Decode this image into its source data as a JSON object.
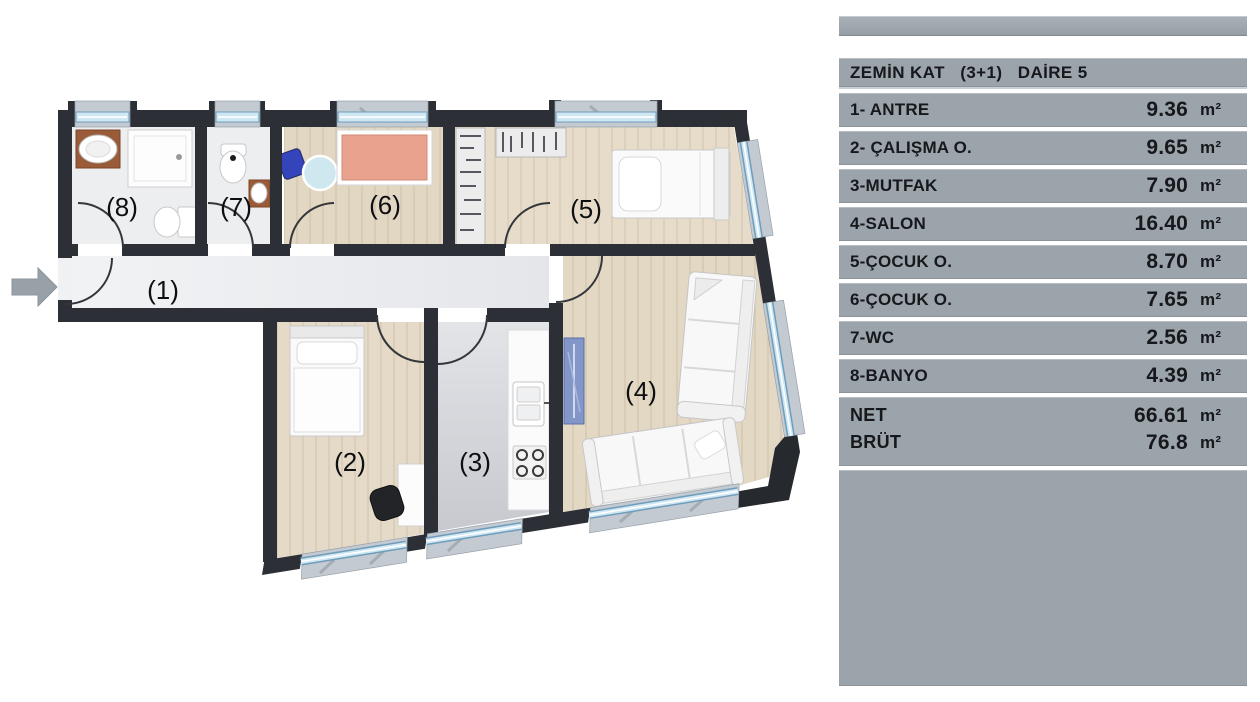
{
  "panel": {
    "title": "ZEMİN KAT   (3+1)   DAİRE 5",
    "rows": [
      {
        "label": "1- ANTRE",
        "value": "9.36",
        "unit": "m²"
      },
      {
        "label": "2- ÇALIŞMA O.",
        "value": "9.65",
        "unit": "m²"
      },
      {
        "label": "3-MUTFAK",
        "value": "7.90",
        "unit": "m²"
      },
      {
        "label": "4-SALON",
        "value": "16.40",
        "unit": "m²"
      },
      {
        "label": "5-ÇOCUK O.",
        "value": "8.70",
        "unit": "m²"
      },
      {
        "label": "6-ÇOCUK O.",
        "value": "7.65",
        "unit": "m²"
      },
      {
        "label": "7-WC",
        "value": "2.56",
        "unit": "m²"
      },
      {
        "label": "8-BANYO",
        "value": "4.39",
        "unit": "m²"
      }
    ],
    "totals": [
      {
        "label": "NET",
        "value": "66.61",
        "unit": "m²"
      },
      {
        "label": "BRÜT",
        "value": "76.8",
        "unit": "m²"
      }
    ]
  },
  "floor_plan": {
    "room_labels": [
      "(1)",
      "(2)",
      "(3)",
      "(4)",
      "(5)",
      "(6)",
      "(7)",
      "(8)"
    ]
  },
  "colors": {
    "panel_gray": "#9ba4ab",
    "wall_dark": "#2c2f35",
    "wood_floor": "#e4dac7",
    "marble_floor": "#eef0f2",
    "window_glass": "#cfe7f2",
    "window_sill": "#c3cad1",
    "bed_salmon": "#e8a28e",
    "chair_blue": "#3444bb",
    "table_cyan": "#cfe8ef",
    "console_blue": "#8296c8",
    "arrow_gray": "#99a1a8"
  }
}
